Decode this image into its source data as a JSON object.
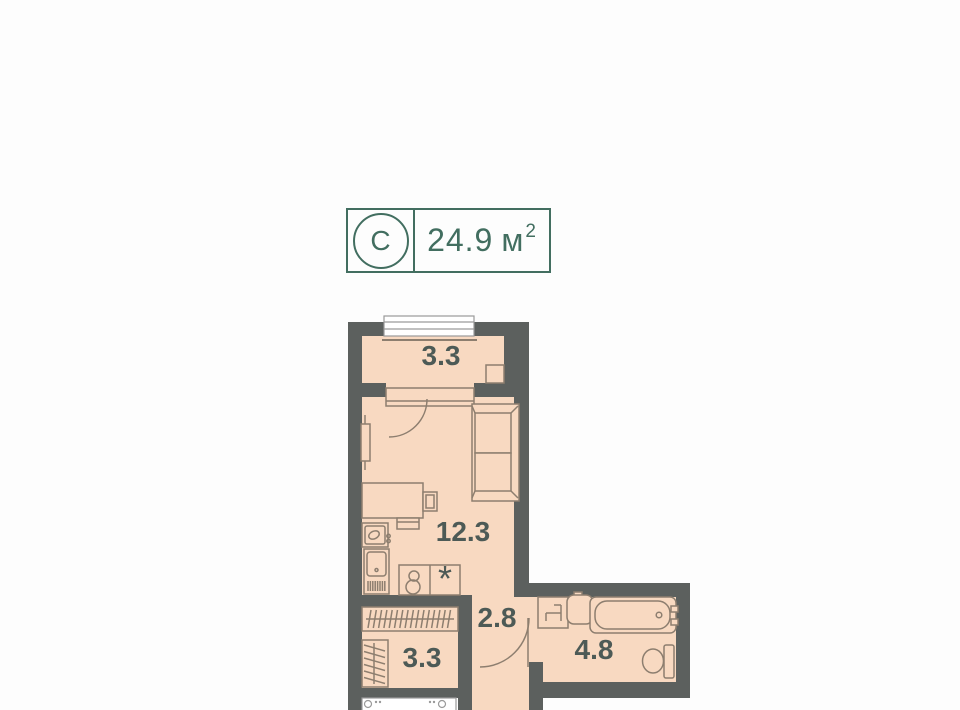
{
  "header": {
    "type_letter": "С",
    "area_value": "24.9",
    "area_unit": "м",
    "area_sup": "2"
  },
  "rooms": {
    "balcony": {
      "area": "3.3"
    },
    "living": {
      "area": "12.3"
    },
    "corridor": {
      "area": "2.8"
    },
    "wardrobe": {
      "area": "3.3"
    },
    "bathroom": {
      "area": "4.8"
    }
  },
  "plan": {
    "appliance_marker": "*"
  },
  "icons": [
    "balcony-door-arc-icon",
    "radiator-icon",
    "sofa-icon",
    "desk-icon",
    "chair-icon",
    "kitchen-sink-icon",
    "kitchen-unit-icon",
    "stove-icon",
    "wardrobe-rail-icon",
    "bath-door-arc-icon",
    "washing-machine-spot-icon",
    "bath-sink-icon",
    "bathtub-icon",
    "toilet-icon",
    "window-icon",
    "entry-fixture-icon"
  ],
  "colors": {
    "accent": "#426e60",
    "wall": "#5c605e",
    "floor": "#f8d9c1",
    "line": "#8d7e6f",
    "label": "#4d5a56",
    "window_frame": "#9a9a9a"
  }
}
